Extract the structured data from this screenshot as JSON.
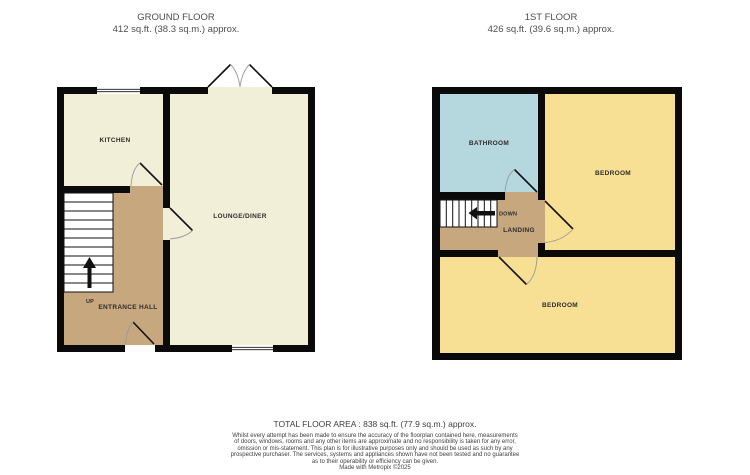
{
  "colors": {
    "wall": "#0a0a0a",
    "cream": "#F2EFD9",
    "tan": "#C7A77D",
    "yellow": "#F7DF93",
    "blue": "#B5D7DE",
    "stair_white": "#FFFFFF",
    "window_white": "#FFFFFF"
  },
  "ground_floor": {
    "title": "GROUND FLOOR",
    "subtitle": "412 sq.ft. (38.3 sq.m.) approx.",
    "rooms": {
      "kitchen": "KITCHEN",
      "lounge": "LOUNGE/DINER",
      "hall": "ENTRANCE HALL"
    },
    "stairs_label": "UP"
  },
  "first_floor": {
    "title": "1ST FLOOR",
    "subtitle": "426 sq.ft. (39.6 sq.m.) approx.",
    "rooms": {
      "bathroom": "BATHROOM",
      "bedroom_right": "BEDROOM",
      "bedroom_bottom": "BEDROOM",
      "landing": "LANDING"
    },
    "stairs_label": "DOWN"
  },
  "footer": {
    "total_area": "TOTAL FLOOR AREA : 838 sq.ft. (77.9 sq.m.) approx.",
    "disclaimer_lines": [
      "Whilst every attempt has been made to ensure the accuracy of the floorplan contained here, measurements",
      "of doors, windows, rooms and any other items are approximate and no responsibility is taken for any error,",
      "omission or mis-statement. This plan is for illustrative purposes only and should be used as such by any",
      "prospective purchaser. The services, systems and appliances shown have not been tested and no guarantee",
      "as to their operability or efficiency can be given."
    ],
    "credit": "Made with Metropix ©2025"
  }
}
